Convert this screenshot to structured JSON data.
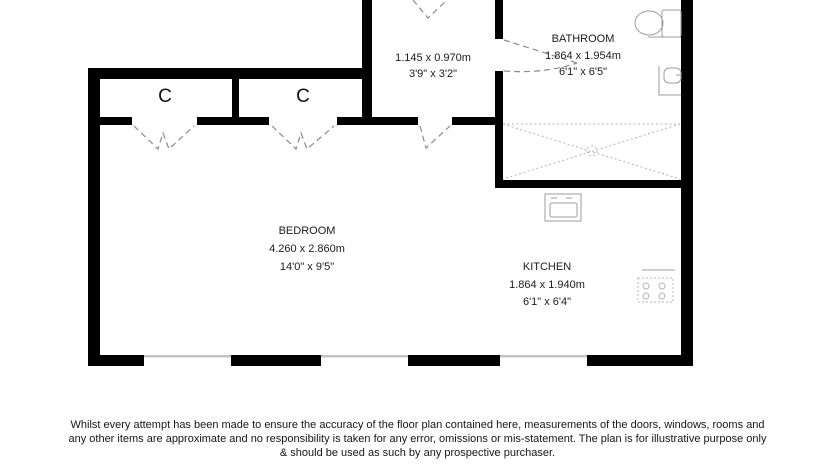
{
  "floorplan": {
    "rooms": {
      "bathroom": {
        "name": "BATHROOM",
        "metric": "1.864 x 1.954m",
        "imperial": "6'1\" x 6'5\""
      },
      "bedroom": {
        "name": "BEDROOM",
        "metric": "4.260 x 2.860m",
        "imperial": "14'0\" x 9'5\""
      },
      "kitchen": {
        "name": "KITCHEN",
        "metric": "1.864 x 1.940m",
        "imperial": "6'1\" x 6'4\""
      },
      "hallway": {
        "metric": "1.145 x 0.970m",
        "imperial": "3'9\" x 3'2\""
      },
      "closet_left": {
        "label": "C"
      },
      "closet_right": {
        "label": "C"
      }
    },
    "fixtures": [
      "toilet-icon",
      "bathroom-sink-icon",
      "shower-icon",
      "kitchen-sink-icon",
      "hob-icon"
    ],
    "colors": {
      "wall": "#000000",
      "window": "#c4c4c4",
      "door_dash": "#8c8c8c",
      "fixture": "#9c9c9c",
      "text": "#1b1b1b"
    }
  },
  "disclaimer": {
    "line1": "Whilst every attempt has been made to ensure the accuracy of the floor plan contained here, measurements of the doors, windows, rooms and",
    "line2": "any other items are approximate and no responsibility is taken for any error, omissions or mis-statement. The plan is for illustrative purpose only",
    "line3": "& should be used as such by any prospective purchaser."
  }
}
